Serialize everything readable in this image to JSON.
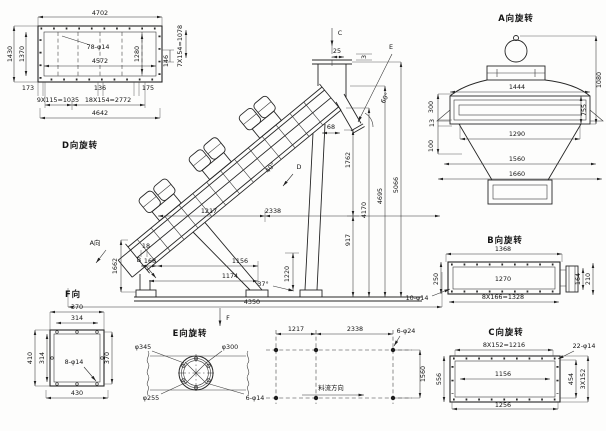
{
  "drawing": {
    "background": "#fdfdfc",
    "line_color": "#262626",
    "type": "engineering-multiview-drawing",
    "subject": "inclined vibrating conveyor with three vibration motors"
  },
  "views": {
    "d": {
      "title": "D向旋转",
      "holes": "78-φ14",
      "w_top": "4702",
      "w_in": "4572",
      "h_out": "1430",
      "h_in": "1370",
      "r_in": "1280",
      "r_off": "146",
      "r_pitch": "7X154=1078",
      "b1": "173",
      "b2": "136",
      "b3": "175",
      "b_p1": "9X115=1035",
      "b_p2": "18X154=2772",
      "w_bot": "4642"
    },
    "main": {
      "c_label": "C",
      "c25": "25",
      "c3": "3",
      "e_label": "E",
      "a60": "60°",
      "a40": "40°",
      "c68": "68",
      "h1": "1762",
      "h2": "917",
      "h3": "4170",
      "h4": "4695",
      "h5": "5066",
      "d_label": "D",
      "a_label": "A向",
      "b_label": "B",
      "t1662": "1662",
      "t18": "18",
      "t168": "168",
      "t1156": "1156",
      "t1174": "1174",
      "a37": "37°",
      "t1220": "1220",
      "t4350": "4350",
      "x1": "1217",
      "x2": "2338",
      "f_label": "F"
    },
    "a": {
      "title": "A向旋转",
      "w1444": "1444",
      "h1080": "1080",
      "h755": "755",
      "l300": "300",
      "l13": "13",
      "l100": "100",
      "w1290": "1290",
      "w1560": "1560",
      "w1660": "1660"
    },
    "b": {
      "title": "B向旋转",
      "w1368": "1368",
      "w1270": "1270",
      "pitch": "8X166=1328",
      "holes": "10-φ14",
      "h250": "250",
      "e164": "164",
      "e210": "210"
    },
    "c": {
      "title": "C向旋转",
      "pitch": "8X152=1216",
      "holes": "22-φ14",
      "w1156": "1156",
      "w1256": "1256",
      "h556": "556",
      "e454": "454",
      "e_pitch": "3X152"
    },
    "e": {
      "title": "E向旋转",
      "d1": "φ345",
      "d2": "φ300",
      "d3": "φ255",
      "holes": "6-φ14"
    },
    "f": {
      "title": "F向",
      "t370": "370",
      "t314": "314",
      "l410": "410",
      "l314": "314",
      "r370": "370",
      "b430": "430",
      "holes": "8-φ14"
    },
    "plan": {
      "x1": "1217",
      "x2": "2338",
      "holes": "6-φ24",
      "depth": "1560",
      "flow": "料流方向"
    }
  }
}
